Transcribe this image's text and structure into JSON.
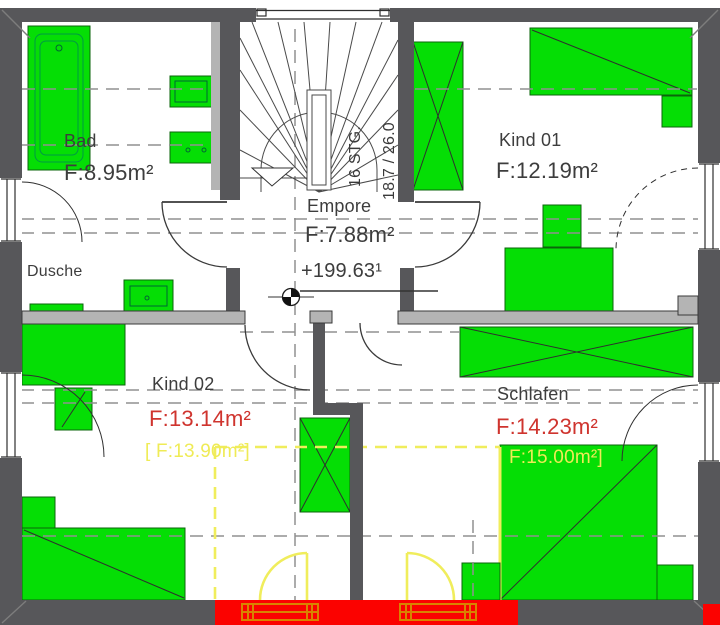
{
  "rooms": {
    "bad": {
      "name": "Bad",
      "area": "F:8.95m²"
    },
    "dusche": {
      "name": "Dusche"
    },
    "empore": {
      "name": "Empore",
      "area": "F:7.88m²",
      "level": "+199.63¹"
    },
    "kind01": {
      "name": "Kind 01",
      "area": "F:12.19m²"
    },
    "kind02": {
      "name": "Kind 02",
      "area": "F:13.14m²",
      "planned_area": "[ F:13.90m²]"
    },
    "schlafen": {
      "name": "Schlafen",
      "area": "F:14.23m²",
      "planned_area": "F:15.00m²]"
    }
  },
  "stairs": {
    "steps": "16 STG.",
    "riser_tread": "18.7 / 26.0"
  },
  "colors": {
    "wall_dark": "#57575a",
    "wall_light": "#b4b4b4",
    "furniture_green": "#05de05",
    "existing_text_red": "#cf342e",
    "planned_yellow": "#f0ed5c",
    "balcony_red": "#fb0200",
    "balcony_symbol_orange": "#d88400"
  }
}
